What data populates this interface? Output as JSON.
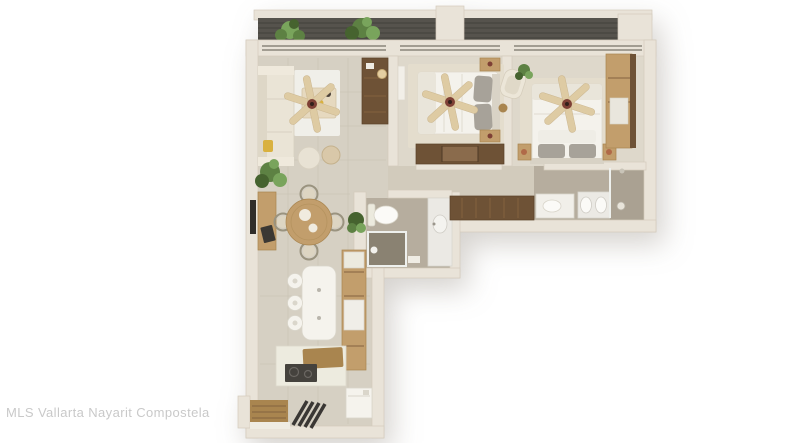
{
  "meta": {
    "kind": "floor-plan-render",
    "description": "Top-down 3D rendered floor plan of a two-bedroom, two-bathroom apartment with L-shaped layout, balcony at top and entry stairs at bottom"
  },
  "watermark": {
    "text": "MLS Vallarta Nayarit Compostela"
  },
  "palette": {
    "background": "#ffffff",
    "wall": "#e9e3d8",
    "wall_edge": "#d3cbbc",
    "floor_main": "#d6d0c3",
    "floor_hall": "#d2cbbc",
    "floor_bedroom": "#ded8cb",
    "floor_bath": "#b6ad9e",
    "floor_shower": "#aaa192",
    "shower_dark": "#8a8272",
    "balcony_floor": "#56534d",
    "balcony_slat": "#47443f",
    "window_line": "#8b867b",
    "glass": "#eef0ed",
    "wood_light": "#c29e6c",
    "wood_mid": "#a9854f",
    "wood_dark": "#6e5236",
    "wood_plank": "#84633f",
    "white_furniture": "#f5f3ed",
    "cream": "#eae4d6",
    "rug_white": "#f0efe9",
    "rug_light": "#e4ddcd",
    "textile_gray": "#a7a299",
    "marble": "#ebe9e4",
    "plant": "#5d8143",
    "plant_dark": "#46632f",
    "plant_light": "#79a45c",
    "fan_blade": "#decba3",
    "fan_hub": "#7e4035",
    "copper": "#b06a48",
    "accent_yellow": "#d9b13f",
    "appliance_dark": "#45423d",
    "tile_line": "#c9c2b3",
    "watermark": "#c9c9c9"
  },
  "scene": {
    "rooms": [
      "balcony",
      "living-room",
      "dining-area",
      "kitchen",
      "entry-hall",
      "hallway",
      "bathroom-2",
      "master-bathroom",
      "bedroom-2",
      "master-bedroom",
      "laundry-closet"
    ],
    "furniture": [
      "sofa",
      "coffee-table",
      "ceiling-fan-x3",
      "round-dining-table",
      "dining-chairs-x4",
      "kitchen-island",
      "bar-stools-x3",
      "tall-kitchen-cabinets",
      "cooktop-counter",
      "washer",
      "stairs",
      "entry-mat",
      "tv-console",
      "wall-tv",
      "media-cabinet",
      "floor-lamp",
      "bed-x2",
      "dresser",
      "wardrobe",
      "nightstands",
      "armchair",
      "toilet",
      "shower-x2",
      "vanity-sink",
      "double-sink-vanity",
      "bathtub-vanity",
      "plants"
    ]
  }
}
